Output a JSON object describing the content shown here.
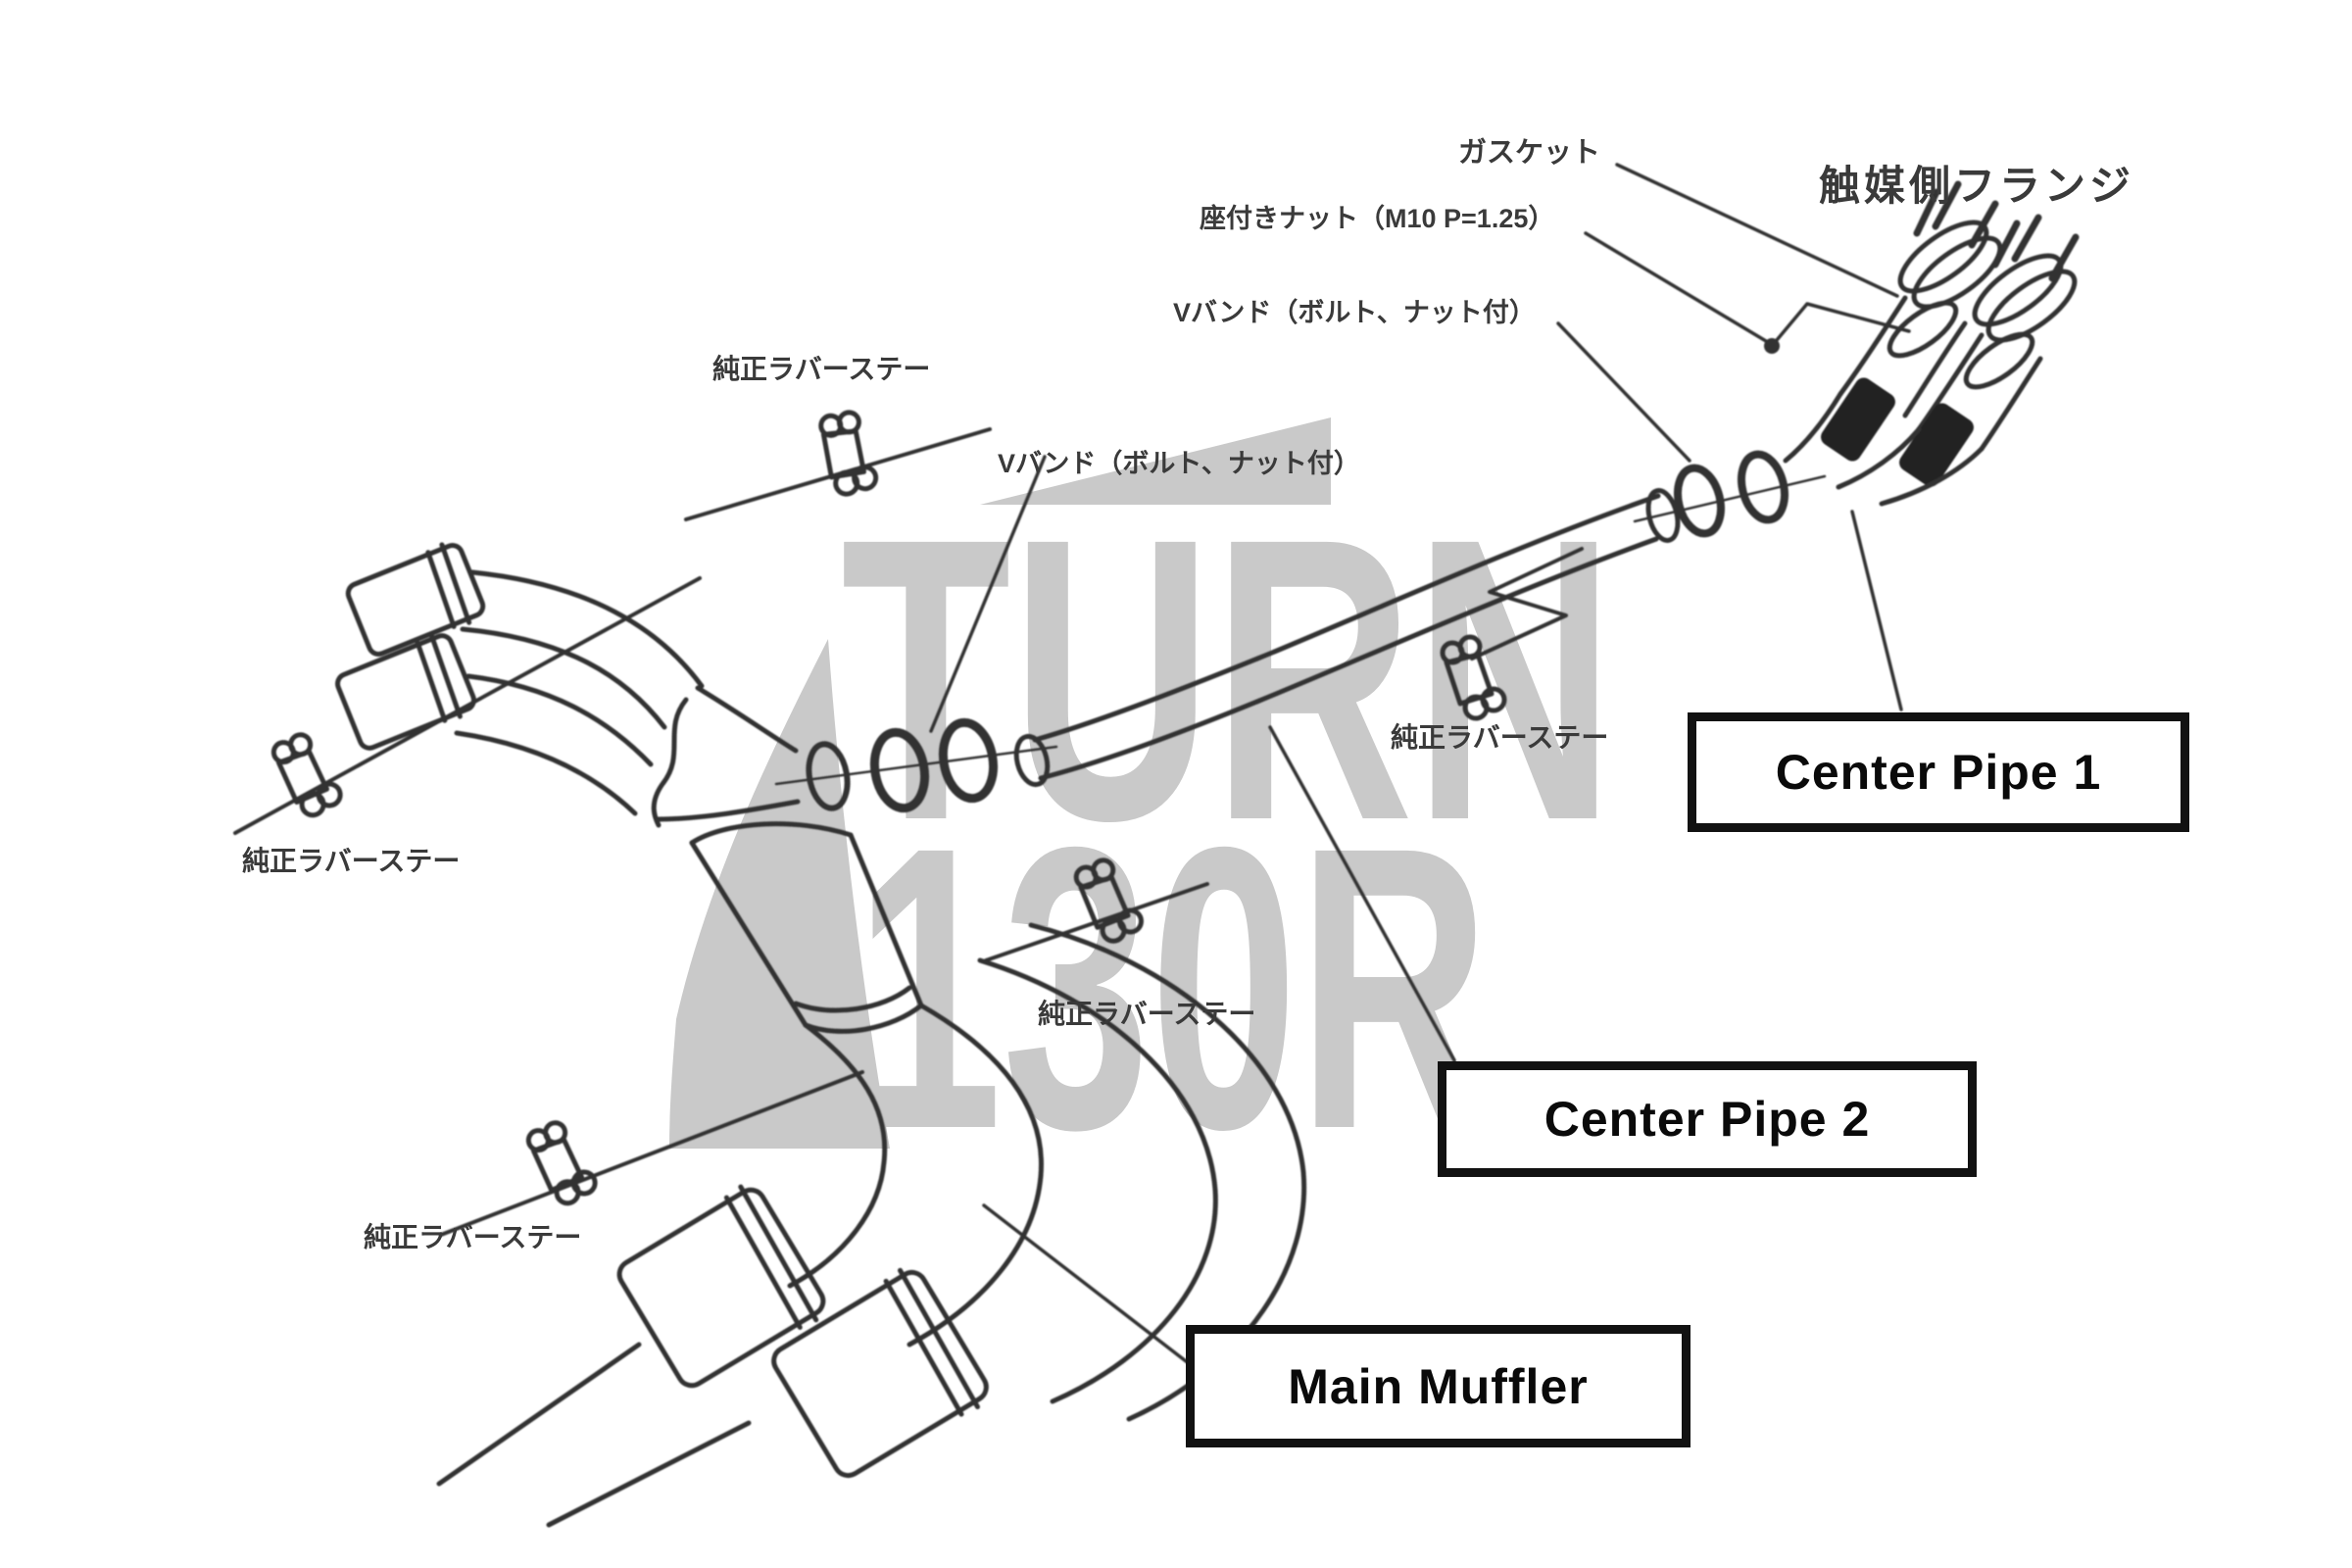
{
  "watermark": {
    "top": "TURN",
    "bottom": "130R"
  },
  "part_labels": [
    {
      "id": "gasket",
      "text": "ガスケット"
    },
    {
      "id": "flanged-nut",
      "text": "座付きナット（M10 P=1.25）"
    },
    {
      "id": "catalyst-side-flange",
      "text": "触媒側フランジ"
    },
    {
      "id": "v-band-upper",
      "text": "Vバンド（ボルト、ナット付）"
    },
    {
      "id": "v-band-lower",
      "text": "Vバンド（ボルト、ナット付）"
    },
    {
      "id": "rubber-stay-1",
      "text": "純正ラバーステー"
    },
    {
      "id": "rubber-stay-2",
      "text": "純正ラバーステー"
    },
    {
      "id": "rubber-stay-3",
      "text": "純正ラバーステー"
    },
    {
      "id": "rubber-stay-4",
      "text": "純正ラバーステー"
    },
    {
      "id": "rubber-stay-5",
      "text": "純正ラバーステー"
    }
  ],
  "boxed_part_names": [
    {
      "id": "center-pipe-1",
      "text": "Center Pipe 1"
    },
    {
      "id": "center-pipe-2",
      "text": "Center Pipe 2"
    },
    {
      "id": "main-muffler",
      "text": "Main Muffler"
    }
  ],
  "colors": {
    "background": "#ffffff",
    "line_art": "#333333",
    "flex_band": "#212121",
    "watermark_gray": "#c9c9c9",
    "box_border": "#121212",
    "label_text": "#3a3a3a"
  }
}
